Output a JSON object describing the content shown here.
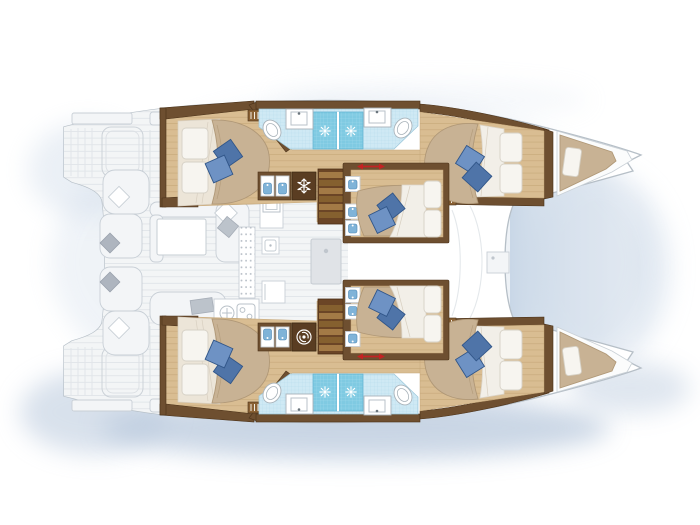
{
  "document": {
    "type": "floor-plan",
    "subject": "sailing catamaran yacht — accommodation deck plan, top-down view",
    "visible_text": "none",
    "orientation": {
      "bow": "right",
      "stern": "left",
      "port_hull": "top",
      "starboard_hull": "bottom"
    }
  },
  "palette": {
    "background": "#ffffff",
    "water_shadow": "#ccd9e8",
    "water_shadow_strong": "#b9c9dd",
    "hull_outline": "#b6bfc7",
    "deck_fill": "#f3f5f6",
    "deck_lines": "#e1e5e9",
    "furniture_outline": "#c8cfd6",
    "wood_floor": "#d9bd92",
    "wood_plank_line": "#c5a678",
    "wood_dark": "#6e4f30",
    "wood_dark_stroke": "#4a3118",
    "wood_mid": "#8a6134",
    "bed_tan": "#c8b294",
    "bed_tan_shade": "#b09877",
    "blanket_cream": "#ece5d8",
    "pillow_white": "#f7f5f0",
    "pillow_blue_light": "#6e92c4",
    "pillow_blue_dark": "#4f74a8",
    "pillow_blue_stroke": "#315689",
    "tile_light": "#cfe9f4",
    "tile_light_grid": "#b3d9ea",
    "tile_shower": "#7fcae2",
    "tile_shower_grid": "#a8dcee",
    "porcelain_stroke": "#a9b3ba",
    "basin_blue": "#7fb3d8",
    "icon_white": "#ffffff",
    "slider_red": "#c42323",
    "trampoline": "#c2d2e4",
    "appliance_dark": "#5a3d22"
  },
  "rooms": [
    {
      "id": "port-aft-cabin",
      "name": "Port aft double cabin",
      "furniture": [
        "double bed",
        "2 white pillows",
        "2 blue cushions",
        "wardrobe",
        "louvered locker"
      ]
    },
    {
      "id": "port-aft-bathroom",
      "name": "Port aft bathroom",
      "furniture": [
        "toilet",
        "washbasin",
        "tiled shower stall with shower icon"
      ]
    },
    {
      "id": "port-fwd-bathroom",
      "name": "Port forward bathroom",
      "furniture": [
        "toilet",
        "washbasin",
        "tiled shower stall with shower icon"
      ]
    },
    {
      "id": "port-companionway",
      "name": "Port hull companionway",
      "furniture": [
        "stairs",
        "twin washbasin cabinet",
        "freezer unit with snowflake icon"
      ]
    },
    {
      "id": "port-forward-cabin",
      "name": "Port forward double cabin",
      "furniture": [
        "double bed",
        "2 white pillows",
        "2 blue cushions",
        "wardrobe"
      ]
    },
    {
      "id": "port-bow-berth",
      "name": "Port bow crew berth",
      "furniture": [
        "single berth mattress",
        "pillow"
      ]
    },
    {
      "id": "starboard-aft-cabin",
      "name": "Starboard aft double cabin",
      "furniture": [
        "double bed",
        "2 white pillows",
        "2 blue cushions",
        "wardrobe",
        "louvered locker"
      ]
    },
    {
      "id": "starboard-aft-bathroom",
      "name": "Starboard aft bathroom",
      "furniture": [
        "toilet",
        "washbasin",
        "tiled shower stall with shower icon"
      ]
    },
    {
      "id": "starboard-fwd-bathroom",
      "name": "Starboard forward bathroom",
      "furniture": [
        "toilet",
        "washbasin",
        "tiled shower stall with shower icon"
      ]
    },
    {
      "id": "starboard-companionway",
      "name": "Starboard hull companionway",
      "furniture": [
        "stairs",
        "twin washbasin cabinet",
        "washing machine with drum icon"
      ]
    },
    {
      "id": "starboard-forward-cabin",
      "name": "Starboard forward double cabin",
      "furniture": [
        "double bed",
        "2 white pillows",
        "2 blue cushions",
        "wardrobe"
      ]
    },
    {
      "id": "starboard-bow-berth",
      "name": "Starboard bow crew berth",
      "furniture": [
        "single berth mattress",
        "pillow"
      ]
    },
    {
      "id": "center-cabin-port",
      "name": "Forward nacelle cabin (port side)",
      "furniture": [
        "double bed",
        "2 blue cushions",
        "3 step shelves with blue cushions",
        "red sliding-door arrow"
      ]
    },
    {
      "id": "center-cabin-starboard",
      "name": "Forward nacelle cabin (starboard side)",
      "furniture": [
        "double bed",
        "2 blue cushions",
        "3 step shelves with blue cushions",
        "red sliding-door arrow"
      ]
    },
    {
      "id": "saloon",
      "name": "Saloon and galley (main deck, drawn faint)",
      "furniture": [
        "L-sofa",
        "white coffee table",
        "scatter cushions",
        "dotted sideboard",
        "galley sink",
        "oven",
        "stove with burners",
        "round sink",
        "fridge",
        "TV cabinet"
      ]
    },
    {
      "id": "cockpit",
      "name": "Aft cockpit (drawn faint)",
      "furniture": [
        "lounge seats",
        "scatter cushions",
        "davit platform outlines",
        "transom benches"
      ]
    },
    {
      "id": "swim-platforms",
      "name": "Twin transom swim platforms with steps"
    },
    {
      "id": "foredeck",
      "name": "Foredeck with deck locker"
    },
    {
      "id": "trampoline",
      "name": "Bow trampoline area (blue-gray wash)"
    }
  ],
  "icons": [
    {
      "name": "shower-sun-icon",
      "count": 4,
      "color": "#ffffff"
    },
    {
      "name": "freezer-snowflake-icon",
      "count": 1,
      "color": "#ffffff"
    },
    {
      "name": "washing-machine-icon",
      "count": 1,
      "color": "#ffffff"
    },
    {
      "name": "sliding-door-arrow",
      "count": 2,
      "color": "#c42323"
    }
  ],
  "counts": {
    "double_bed_cabins": 6,
    "bow_berths": 2,
    "bathrooms": 4,
    "shower_stalls": 4,
    "toilets": 4,
    "blue_cushions": 12,
    "swim_platforms": 2
  }
}
